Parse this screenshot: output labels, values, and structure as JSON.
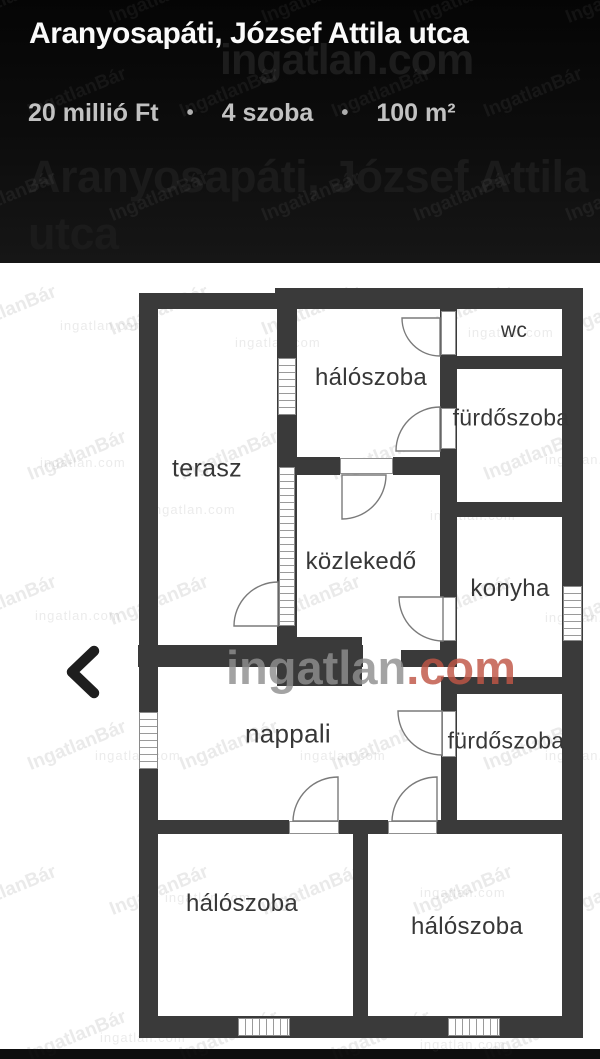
{
  "header": {
    "title": "Aranyosapáti, József Attila utca",
    "price": "20 millió Ft",
    "rooms": "4 szoba",
    "area": "100 m²",
    "separator": "•",
    "ghost_title_line1": "Aranyosapáti, József Attila",
    "ghost_title_line2": "utca"
  },
  "watermarks": {
    "brand_name": "ingatlan",
    "brand_tld": ".com",
    "tile": "IngatlanBár",
    "faint": "ingatlan.com"
  },
  "floorplan": {
    "rooms": [
      {
        "label": "wc",
        "x": 514,
        "y": 331,
        "size": 21
      },
      {
        "label": "hálószoba",
        "x": 371,
        "y": 378,
        "size": 24
      },
      {
        "label": "fürdőszoba",
        "x": 511,
        "y": 418,
        "size": 23
      },
      {
        "label": "terasz",
        "x": 207,
        "y": 469,
        "size": 25
      },
      {
        "label": "közlekedő",
        "x": 361,
        "y": 562,
        "size": 24
      },
      {
        "label": "konyha",
        "x": 510,
        "y": 589,
        "size": 24
      },
      {
        "label": "nappali",
        "x": 288,
        "y": 734,
        "size": 26
      },
      {
        "label": "fürdőszoba",
        "x": 506,
        "y": 741,
        "size": 23
      },
      {
        "label": "hálószoba",
        "x": 242,
        "y": 904,
        "size": 24
      },
      {
        "label": "hálószoba",
        "x": 467,
        "y": 927,
        "size": 24
      }
    ]
  }
}
